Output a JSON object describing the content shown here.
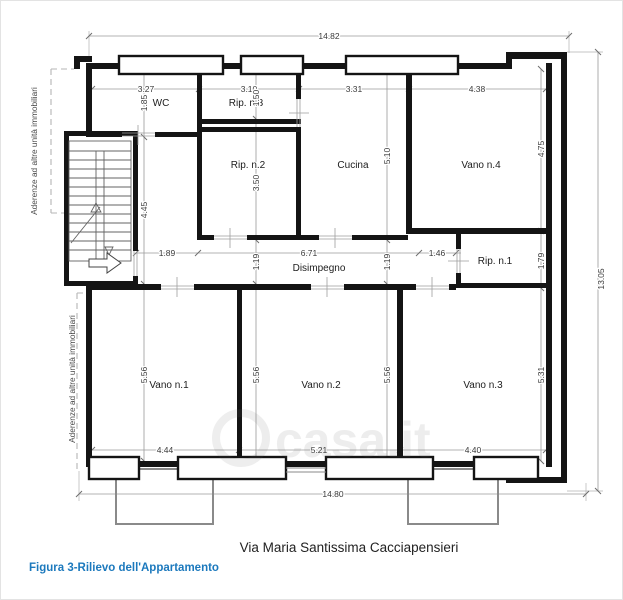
{
  "caption": {
    "address": "Via Maria Santissima Cacciapensieri",
    "figure": "Figura 3-Rilievo dell'Appartamento"
  },
  "watermark": {
    "brand": "casa.it"
  },
  "colors": {
    "wall": "#141414",
    "dim_line": "#9a9a9a",
    "dim_text": "#3a3a3a",
    "figure_caption": "#1c79bd",
    "dashed_boundary": "#b5b5b5",
    "balcony": "#8a8a8a"
  },
  "boundary": {
    "label_upper": "Aderenze ad altre unità immobiliari",
    "label_lower": "Aderenze ad altre unità immobiliari"
  },
  "overall": {
    "width_top": "14.82",
    "height_right": "13.05",
    "width_bottom": "14.80"
  },
  "rooms": {
    "wc": {
      "name": "WC",
      "w": "3.27",
      "d": "1.85"
    },
    "rip3": {
      "name": "Rip. n.3",
      "w": "3.10",
      "d": "1.50"
    },
    "rip2": {
      "name": "Rip. n.2",
      "d": "3.50"
    },
    "cucina": {
      "name": "Cucina",
      "w": "3.31",
      "d": "5.10"
    },
    "vano4": {
      "name": "Vano n.4",
      "w": "4.38",
      "d": "4.75"
    },
    "rip1": {
      "name": "Rip. n.1",
      "d": "1.79"
    },
    "disimpegno": {
      "name": "Disimpegno",
      "len": "6.71",
      "w_left": "1.19",
      "w_right": "1.19"
    },
    "entry": {
      "w": "1.89",
      "stair_d": "4.45",
      "stub_w": "1.46"
    },
    "vano1": {
      "name": "Vano n.1",
      "d": "5.56",
      "w": "4.44"
    },
    "vano2": {
      "name": "Vano n.2",
      "d_left": "5.56",
      "d_right": "5.56",
      "w": "5.21"
    },
    "vano3": {
      "name": "Vano n.3",
      "d": "5.31",
      "w": "4.40"
    }
  }
}
